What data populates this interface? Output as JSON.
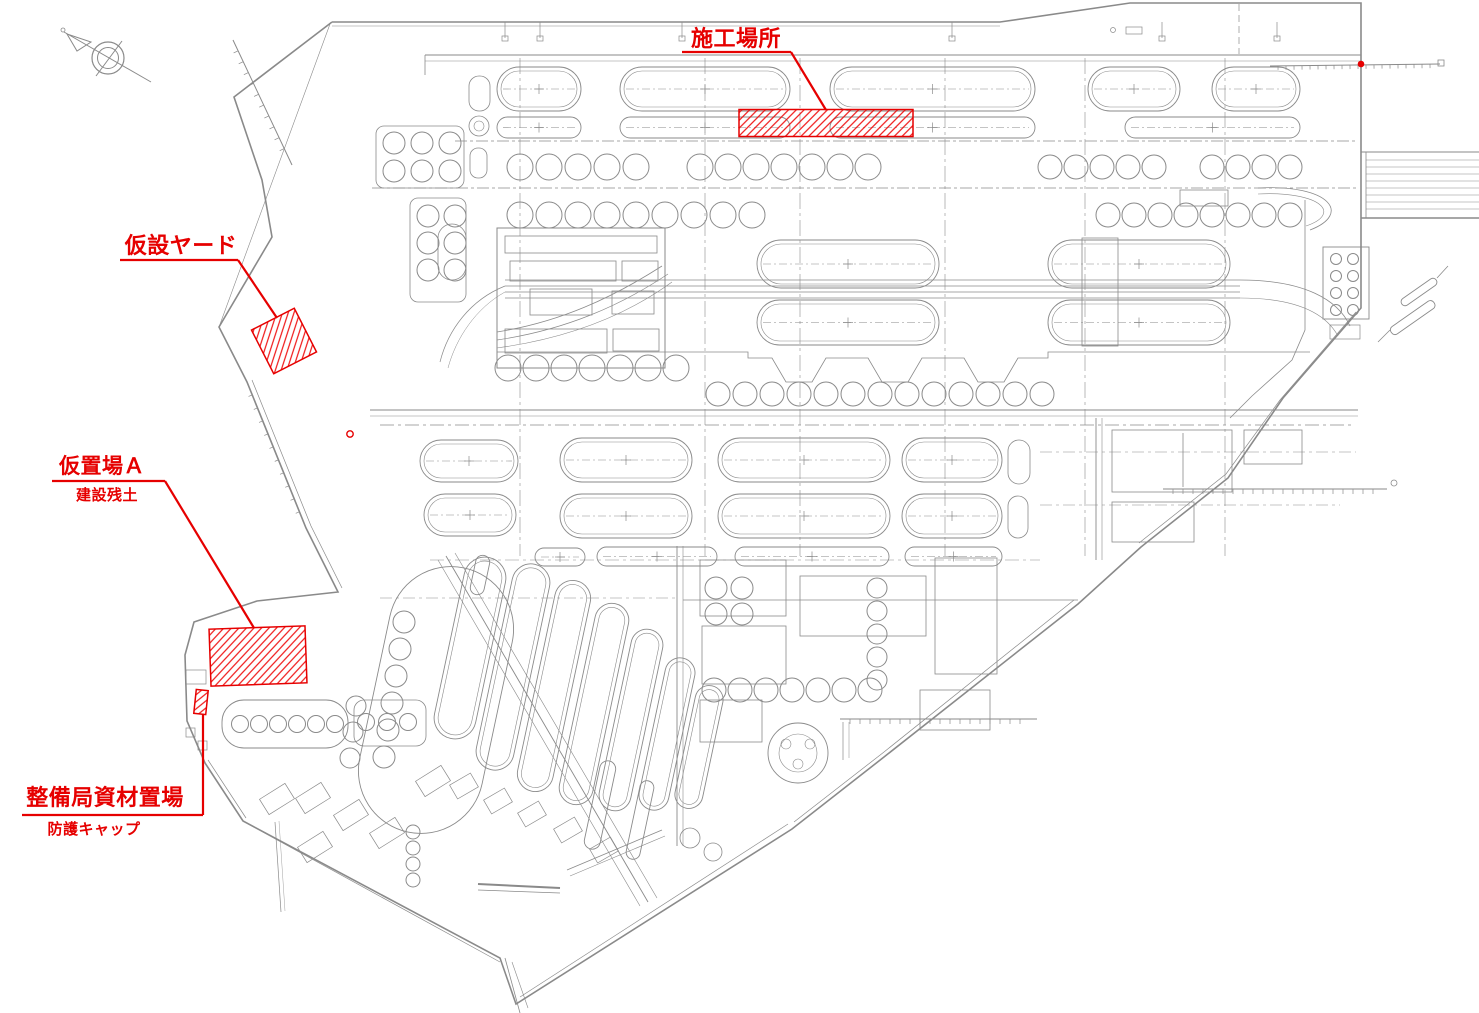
{
  "page": {
    "background": "#ffffff",
    "kind": "construction site location plan"
  },
  "colors": {
    "annotation_red": "#e60000",
    "hatch_red": "#ee0000",
    "drawing_gray": "#8a8a8a"
  },
  "compass": {
    "x": 108,
    "y": 58
  },
  "annotations": [
    {
      "id": "construction-site",
      "label": "施工場所",
      "sublabel": "",
      "font_size": 22,
      "sub_font_size": 0,
      "label_x": 736,
      "label_y": 46,
      "sub_x": 0,
      "sub_y": 0,
      "underline": [
        682,
        52,
        791,
        52
      ],
      "leader": "791,52 826,110",
      "area": {
        "cx": 826,
        "cy": 123,
        "w": 174,
        "h": 27,
        "rotate": 0
      }
    },
    {
      "id": "temporary-yard",
      "label": "仮設ヤード",
      "sublabel": "",
      "font_size": 22,
      "sub_font_size": 0,
      "label_x": 181,
      "label_y": 253,
      "sub_x": 0,
      "sub_y": 0,
      "underline": [
        120,
        260,
        238,
        260
      ],
      "leader": "238,260 277,318",
      "area": {
        "cx": 284,
        "cy": 341,
        "w": 48,
        "h": 49,
        "rotate": -27
      }
    },
    {
      "id": "temporary-storage-a",
      "label": "仮置場Ａ",
      "sublabel": "建設残土",
      "font_size": 21,
      "sub_font_size": 15,
      "label_x": 102,
      "label_y": 473,
      "sub_x": 107,
      "sub_y": 500,
      "underline": [
        52,
        481,
        165,
        481
      ],
      "leader": "165,481 254,628",
      "area": {
        "cx": 258,
        "cy": 656,
        "w": 96,
        "h": 57,
        "rotate": -2
      }
    },
    {
      "id": "maintenance-bureau-material-storage",
      "label": "整備局資材置場",
      "sublabel": "防護キャップ",
      "font_size": 22,
      "sub_font_size": 15,
      "label_x": 105,
      "label_y": 805,
      "sub_x": 94,
      "sub_y": 834,
      "underline": [
        22,
        815,
        203,
        815
      ],
      "leader": "203,815 203,714",
      "area": {
        "cx": 201,
        "cy": 702,
        "w": 12,
        "h": 24,
        "rotate": 6
      }
    }
  ],
  "markers": [
    {
      "id": "pier-end-marker",
      "x": 1361,
      "y": 64,
      "r": 2.6,
      "filled": true
    },
    {
      "id": "small-ring-marker",
      "x": 350,
      "y": 434,
      "r": 3.2,
      "filled": false
    }
  ]
}
